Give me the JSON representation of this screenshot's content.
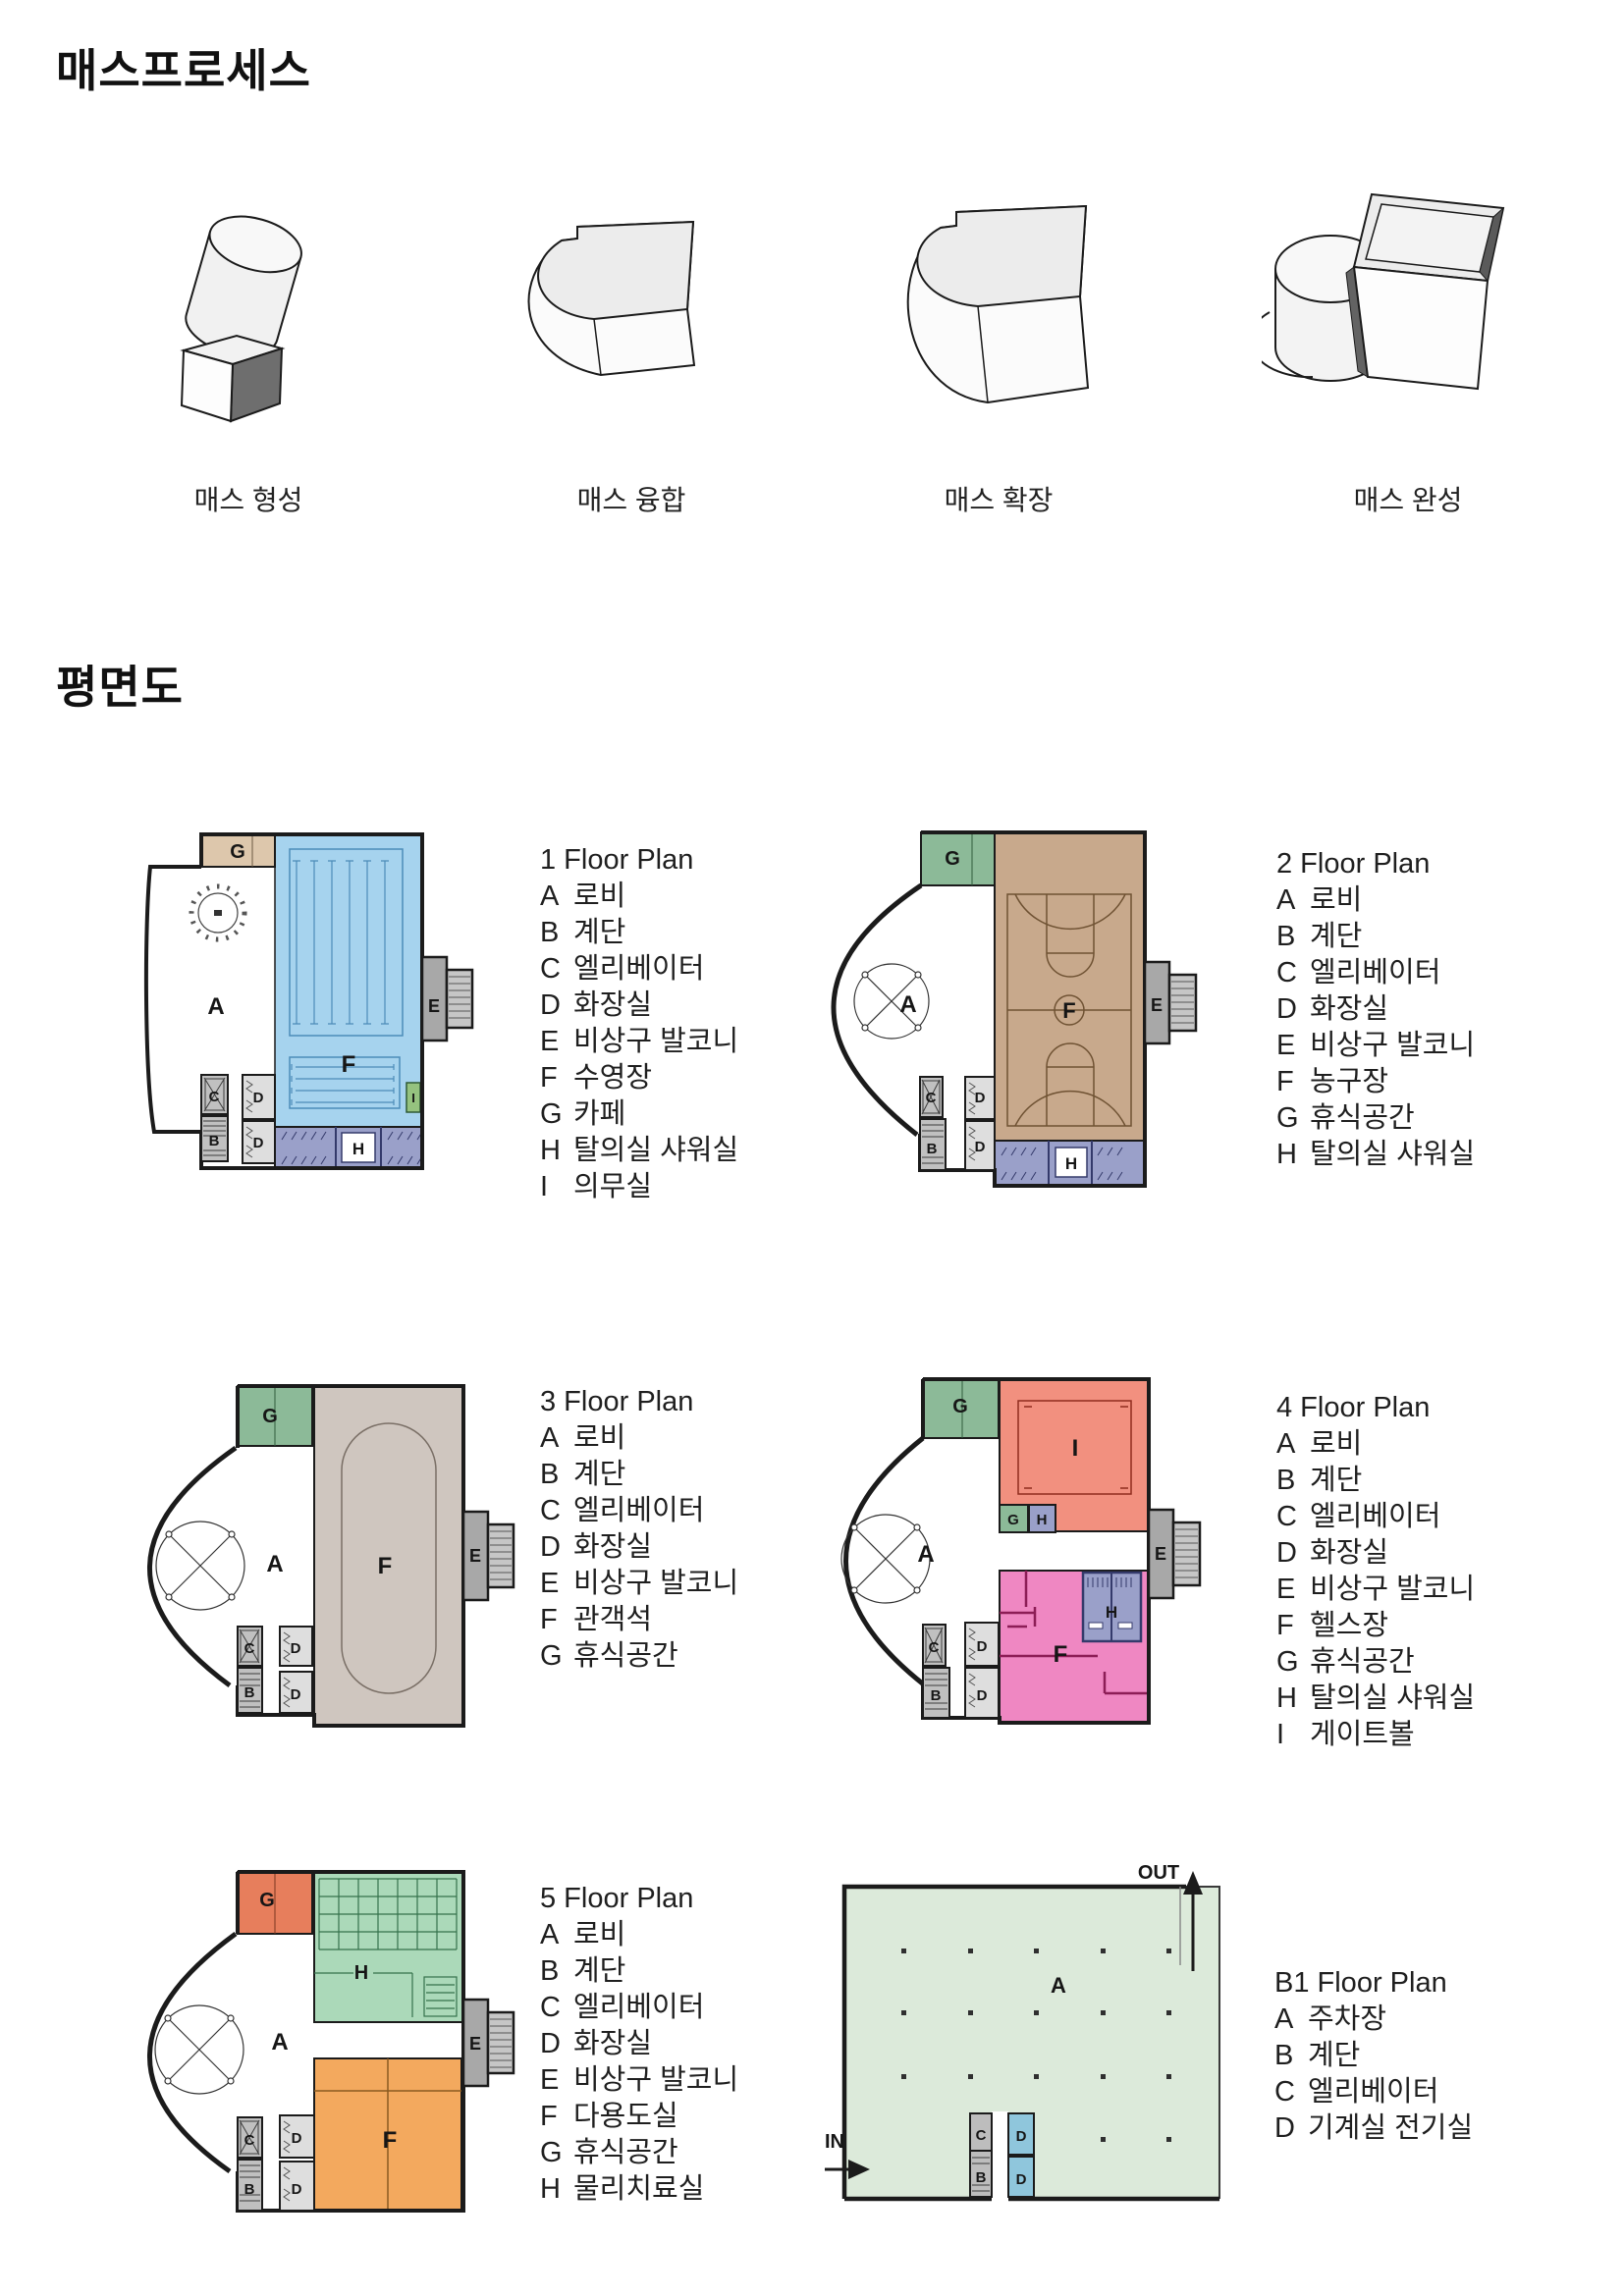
{
  "page": {
    "title": "매스프로세스",
    "floor_section_title": "평면도"
  },
  "mass_process": {
    "captions": [
      "매스 형성",
      "매스 융합",
      "매스 확장",
      "매스 완성"
    ]
  },
  "letters": {
    "A": "A",
    "B": "B",
    "C": "C",
    "D": "D",
    "E": "E",
    "F": "F",
    "G": "G",
    "H": "H",
    "I": "I"
  },
  "b1_labels": {
    "in": "IN",
    "out": "OUT"
  },
  "floor_plans": [
    {
      "title": "1 Floor Plan",
      "legend": [
        {
          "key": "A",
          "label": "로비"
        },
        {
          "key": "B",
          "label": "계단"
        },
        {
          "key": "C",
          "label": "엘리베이터"
        },
        {
          "key": "D",
          "label": "화장실"
        },
        {
          "key": "E",
          "label": "비상구 발코니"
        },
        {
          "key": "F",
          "label": "수영장"
        },
        {
          "key": "G",
          "label": "카페"
        },
        {
          "key": "H",
          "label": "탈의실 샤워실"
        },
        {
          "key": "I",
          "label": "의무실"
        }
      ]
    },
    {
      "title": "2 Floor Plan",
      "legend": [
        {
          "key": "A",
          "label": "로비"
        },
        {
          "key": "B",
          "label": "계단"
        },
        {
          "key": "C",
          "label": "엘리베이터"
        },
        {
          "key": "D",
          "label": "화장실"
        },
        {
          "key": "E",
          "label": "비상구 발코니"
        },
        {
          "key": "F",
          "label": "농구장"
        },
        {
          "key": "G",
          "label": "휴식공간"
        },
        {
          "key": "H",
          "label": "탈의실 샤워실"
        }
      ]
    },
    {
      "title": "3 Floor Plan",
      "legend": [
        {
          "key": "A",
          "label": "로비"
        },
        {
          "key": "B",
          "label": "계단"
        },
        {
          "key": "C",
          "label": "엘리베이터"
        },
        {
          "key": "D",
          "label": "화장실"
        },
        {
          "key": "E",
          "label": "비상구 발코니"
        },
        {
          "key": "F",
          "label": "관객석"
        },
        {
          "key": "G",
          "label": "휴식공간"
        }
      ]
    },
    {
      "title": "4 Floor Plan",
      "legend": [
        {
          "key": "A",
          "label": "로비"
        },
        {
          "key": "B",
          "label": "계단"
        },
        {
          "key": "C",
          "label": "엘리베이터"
        },
        {
          "key": "D",
          "label": "화장실"
        },
        {
          "key": "E",
          "label": "비상구 발코니"
        },
        {
          "key": "F",
          "label": "헬스장"
        },
        {
          "key": "G",
          "label": "휴식공간"
        },
        {
          "key": "H",
          "label": "탈의실 샤워실"
        },
        {
          "key": "I",
          "label": "게이트볼"
        }
      ]
    },
    {
      "title": "5 Floor Plan",
      "legend": [
        {
          "key": "A",
          "label": "로비"
        },
        {
          "key": "B",
          "label": "계단"
        },
        {
          "key": "C",
          "label": "엘리베이터"
        },
        {
          "key": "D",
          "label": "화장실"
        },
        {
          "key": "E",
          "label": "비상구 발코니"
        },
        {
          "key": "F",
          "label": "다용도실"
        },
        {
          "key": "G",
          "label": "휴식공간"
        },
        {
          "key": "H",
          "label": "물리치료실"
        }
      ]
    },
    {
      "title": "B1 Floor Plan",
      "legend": [
        {
          "key": "A",
          "label": "주차장"
        },
        {
          "key": "B",
          "label": "계단"
        },
        {
          "key": "C",
          "label": "엘리베이터"
        },
        {
          "key": "D",
          "label": "기계실 전기실"
        }
      ]
    }
  ],
  "palette": {
    "wall": "#1b1b1b",
    "pool_blue": "#a6d3ee",
    "locker_purple": "#9aa0c9",
    "cafe_tan": "#ddc7ac",
    "rest_green": "#8cba98",
    "court_tan": "#c8a98c",
    "stand_taupe": "#cfc6bf",
    "gateball_red": "#f2907f",
    "gym_pink": "#ef87c2",
    "rest_orange": "#e77e5c",
    "therapy_mint": "#abd9b9",
    "multi_orange": "#f3a95e",
    "parking_green": "#dceada",
    "machine_blue": "#8fc6dc",
    "balcony_gray": "#b3b3b3",
    "medical_green": "#95c27f"
  }
}
